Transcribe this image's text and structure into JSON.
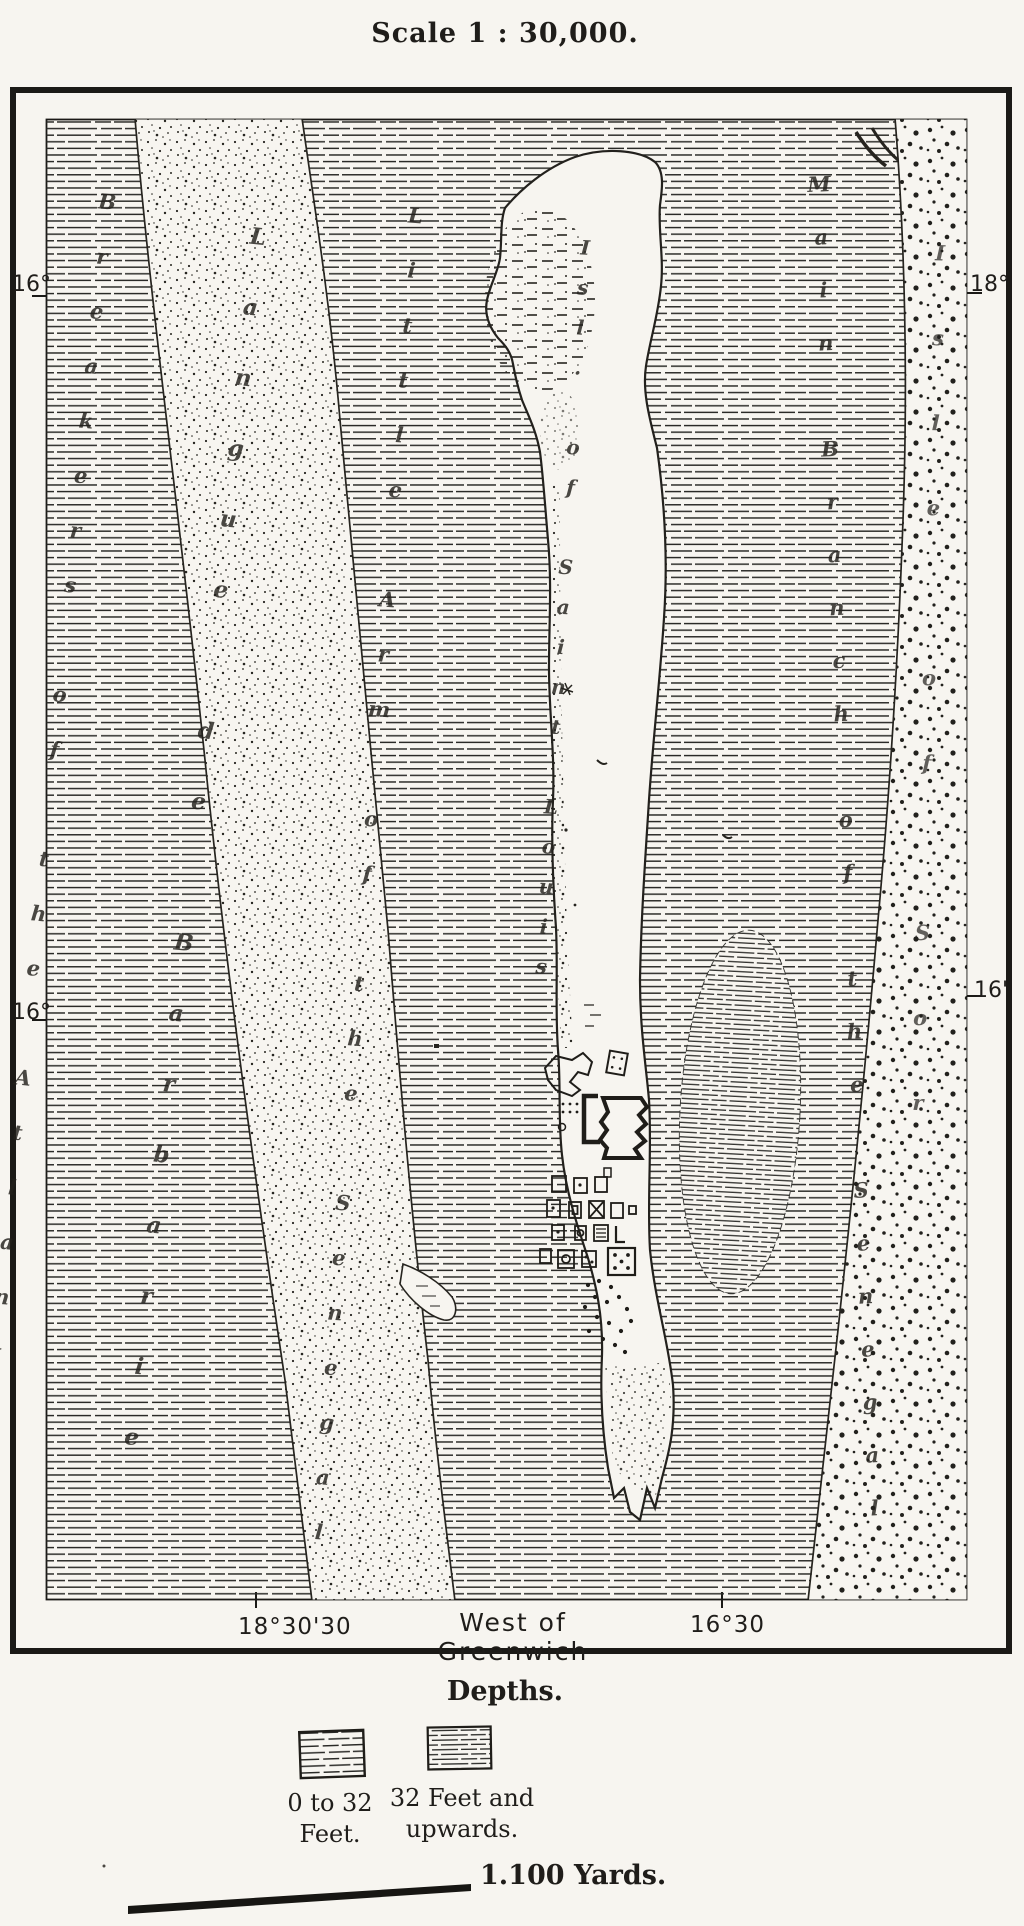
{
  "page": {
    "scale_title": "Scale 1 : 30,000."
  },
  "map": {
    "edge_labels": {
      "left_top": "16°",
      "left_bottom": "16°",
      "right_top": "18°",
      "right_bottom": "16'",
      "bottom_left": "18°30'30",
      "bottom_center": "West of Greenwich",
      "bottom_right": "16°30"
    },
    "feature_labels": [
      {
        "id": "ocean",
        "text": "Breakers of the Atlantic"
      },
      {
        "id": "sand-spit",
        "text": "Langue de Barbarie"
      },
      {
        "id": "little-arm",
        "text": "Little Arm of the Senegal"
      },
      {
        "id": "island",
        "text": "Isl. of Saint Louis"
      },
      {
        "id": "main-branch",
        "text": "Main Branch of the Senegal"
      },
      {
        "id": "east-bank",
        "text": "Isle of Sor"
      }
    ]
  },
  "legend": {
    "title": "Depths.",
    "items": [
      {
        "hatch": "coarse",
        "label_line1": "0 to 32",
        "label_line2": "Feet."
      },
      {
        "hatch": "fine",
        "label_line1": "32 Feet and",
        "label_line2": "upwards."
      }
    ],
    "scale_bar_label": "1.100 Yards."
  },
  "colors": {
    "paper": "#f7f5f0",
    "ink": "#1f1d1a"
  }
}
